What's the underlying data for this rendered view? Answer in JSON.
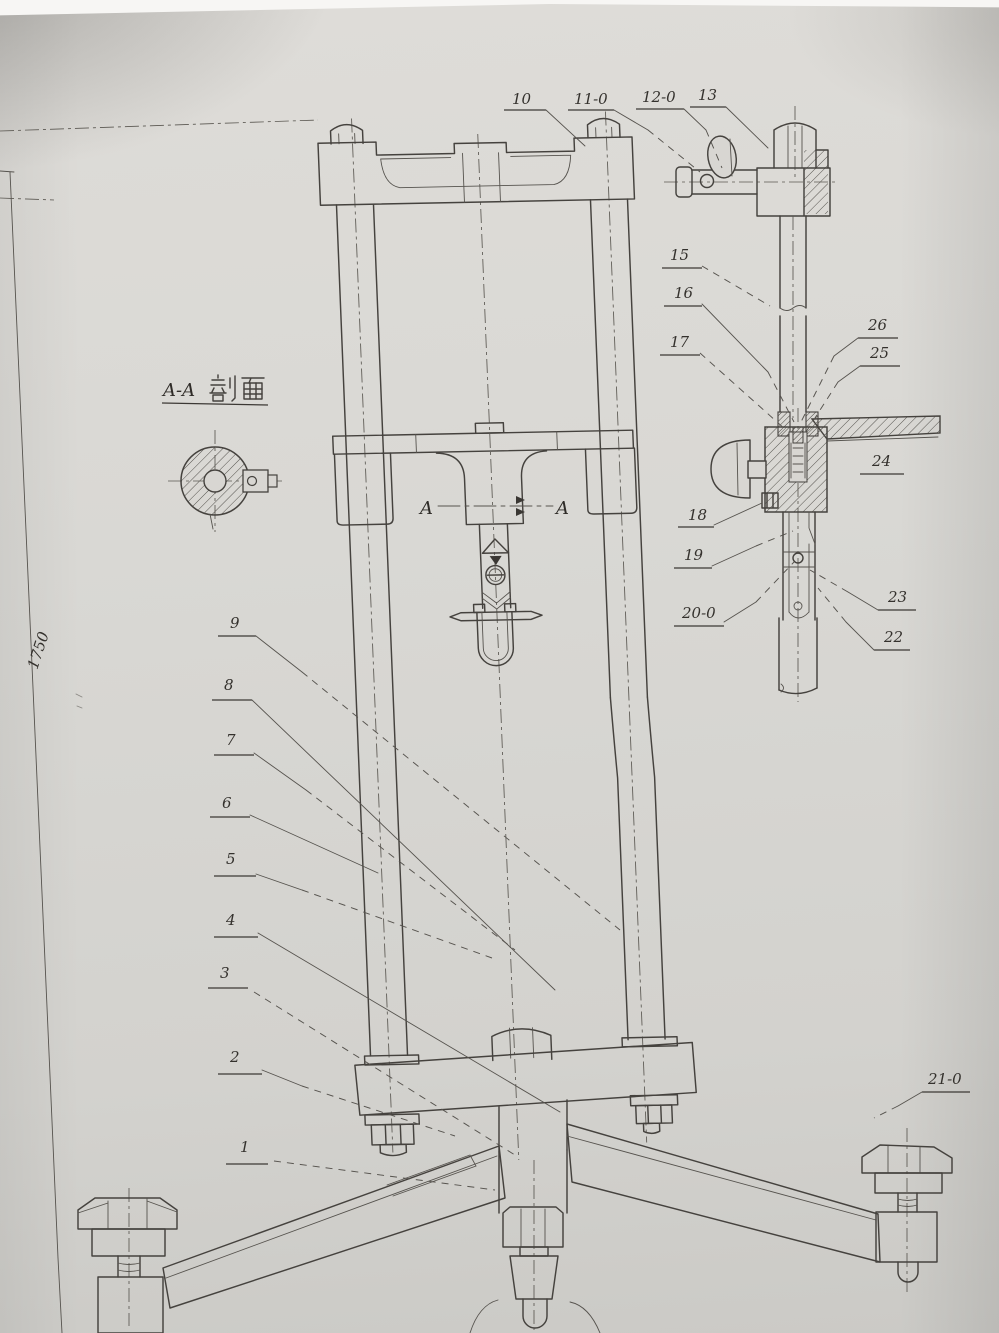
{
  "drawing": {
    "section_view_label": "A-A剖面",
    "section_view_label_latin": "A-A",
    "section_cut_letter": "A",
    "left_dimension": "1750",
    "part_callouts": {
      "n1": "1",
      "n2": "2",
      "n3": "3",
      "n4": "4",
      "n5": "5",
      "n6": "6",
      "n7": "7",
      "n8": "8",
      "n9": "9",
      "n10": "10",
      "n11": "11-0",
      "n12": "12-0",
      "n13": "13",
      "n15": "15",
      "n16": "16",
      "n17": "17",
      "n18": "18",
      "n19": "19",
      "n20": "20-0",
      "n21": "21-0",
      "n22": "22",
      "n23": "23",
      "n24": "24",
      "n25": "25",
      "n26": "26"
    },
    "colors": {
      "paper": "#d8d6d2",
      "ink": "#45423e"
    }
  }
}
